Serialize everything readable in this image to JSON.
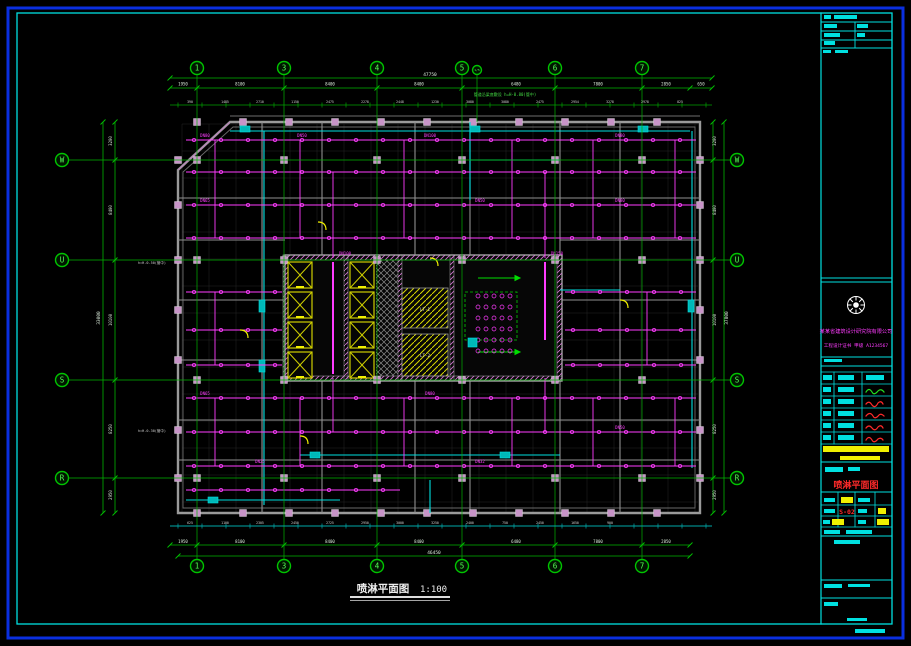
{
  "canvas": {
    "w": 911,
    "h": 646
  },
  "colors": {
    "blue": "#0a2fe0",
    "cyan": "#00e0e0",
    "green": "#00c400",
    "dimline": "#00b400",
    "dimtext": "#dcecdc",
    "magenta": "#ff3cff",
    "yellow": "#f0f000",
    "red": "#ff2a2a",
    "wall": "#9a9a9a",
    "column": "#c894c8",
    "teal": "#00a8a8"
  },
  "titles": {
    "bottom_title": "喷淋平面图",
    "scale": "1:100",
    "red_title": "喷淋平面图",
    "sheet_no": "S-02"
  },
  "company": {
    "line1": "某某省建筑设计研究院有限公司",
    "line2": "工程设计证书 甲级 A1234567"
  },
  "notes": {
    "top": "管道沿梁底敷设 h=H-0.80(管中)",
    "left1": "h=H-0.50(管中)",
    "left2": "h=H-0.30(管中)"
  },
  "rooms": {
    "stair1": "LT-1",
    "stair2": "LT-2"
  },
  "grid": {
    "cols": [
      {
        "label": "1",
        "x": 197
      },
      {
        "label": "3",
        "x": 284
      },
      {
        "label": "4",
        "x": 377
      },
      {
        "label": "5",
        "x": 462
      },
      {
        "label": "1/5",
        "x": 477,
        "small": true
      },
      {
        "label": "6",
        "x": 555
      },
      {
        "label": "7",
        "x": 642
      }
    ],
    "rows": [
      {
        "label": "W",
        "y": 160
      },
      {
        "label": "U",
        "y": 260
      },
      {
        "label": "S",
        "y": 380
      },
      {
        "label": "R",
        "y": 478
      }
    ],
    "top_bubble_y": 68,
    "bottom_bubble_y": 566,
    "left_bubble_x": 62,
    "right_bubble_x": 737
  },
  "dims": {
    "top_total": {
      "t": "47750",
      "x": 430,
      "y": 76
    },
    "bottom_total": {
      "t": "46450",
      "x": 434,
      "y": 554
    },
    "left_total": {
      "t": "33000",
      "x": 100,
      "y": 318
    },
    "right_total": {
      "t": "37800",
      "x": 728,
      "y": 318
    },
    "top_bounds": [
      170,
      197,
      284,
      377,
      462,
      555,
      642,
      690,
      712
    ],
    "bottom_bounds": [
      170,
      197,
      284,
      377,
      462,
      555,
      642,
      690
    ],
    "side_bounds": [
      122,
      160,
      260,
      380,
      478,
      513
    ],
    "top_segments": [
      {
        "t": "1950",
        "x": 183
      },
      {
        "t": "8100",
        "x": 240
      },
      {
        "t": "8400",
        "x": 330
      },
      {
        "t": "8400",
        "x": 419
      },
      {
        "t": "6480",
        "x": 516
      },
      {
        "t": "7800",
        "x": 598
      },
      {
        "t": "2850",
        "x": 666
      },
      {
        "t": "650",
        "x": 701
      }
    ],
    "bottom_segments": [
      {
        "t": "1950",
        "x": 183
      },
      {
        "t": "8100",
        "x": 240
      },
      {
        "t": "8400",
        "x": 330
      },
      {
        "t": "8400",
        "x": 419
      },
      {
        "t": "6480",
        "x": 516
      },
      {
        "t": "7800",
        "x": 598
      },
      {
        "t": "2850",
        "x": 666
      }
    ],
    "left_segments": [
      {
        "t": "3200",
        "y": 141
      },
      {
        "t": "8400",
        "y": 210
      },
      {
        "t": "10100",
        "y": 320
      },
      {
        "t": "8250",
        "y": 429
      },
      {
        "t": "2950",
        "y": 495
      }
    ],
    "right_segments": [
      {
        "t": "3200",
        "y": 141
      },
      {
        "t": "8400",
        "y": 210
      },
      {
        "t": "10100",
        "y": 320
      },
      {
        "t": "8250",
        "y": 429
      },
      {
        "t": "2950",
        "y": 495
      }
    ],
    "top_ticks": [
      "390",
      "1485",
      "2710",
      "1150",
      "2475",
      "2278",
      "2448",
      "1230",
      "3080",
      "3080",
      "2475",
      "2954",
      "3278",
      "2978",
      "825"
    ],
    "bottom_ticks": [
      "625",
      "1100",
      "2305",
      "2450",
      "2725",
      "2950",
      "3000",
      "3250",
      "2400",
      "750",
      "2450",
      "1650",
      "900"
    ]
  },
  "ceil_grid": {
    "x1": 182,
    "x2": 698,
    "y1": 124,
    "y2": 512,
    "step": 27
  },
  "pipes": {
    "head_gap": 27,
    "rows": [
      [
        140,
        186,
        696
      ],
      [
        172,
        186,
        696
      ],
      [
        205,
        186,
        696
      ],
      [
        238,
        186,
        696
      ],
      [
        292,
        186,
        282
      ],
      [
        292,
        565,
        696
      ],
      [
        330,
        186,
        282
      ],
      [
        330,
        565,
        696
      ],
      [
        365,
        186,
        282
      ],
      [
        365,
        565,
        696
      ],
      [
        398,
        186,
        696
      ],
      [
        432,
        186,
        696
      ],
      [
        466,
        186,
        696
      ],
      [
        490,
        186,
        400
      ]
    ],
    "vlines": [
      [
        215,
        140,
        238
      ],
      [
        300,
        140,
        238
      ],
      [
        404,
        140,
        238
      ],
      [
        512,
        140,
        238
      ],
      [
        593,
        140,
        238
      ],
      [
        675,
        140,
        238
      ],
      [
        215,
        292,
        365
      ],
      [
        647,
        292,
        365
      ],
      [
        215,
        398,
        466
      ],
      [
        300,
        398,
        466
      ],
      [
        404,
        398,
        466
      ],
      [
        512,
        398,
        466
      ],
      [
        593,
        398,
        466
      ],
      [
        675,
        398,
        466
      ],
      [
        333,
        172,
        258
      ],
      [
        545,
        172,
        258
      ],
      [
        333,
        378,
        432
      ],
      [
        545,
        378,
        432
      ]
    ],
    "risers": [
      [
        333,
        262,
        374
      ],
      [
        545,
        262,
        340
      ]
    ],
    "dn_labels": [
      {
        "t": "DN80",
        "x": 205,
        "y": 137
      },
      {
        "t": "DN50",
        "x": 302,
        "y": 137
      },
      {
        "t": "DN100",
        "x": 430,
        "y": 137
      },
      {
        "t": "DN80",
        "x": 620,
        "y": 137
      },
      {
        "t": "DN65",
        "x": 205,
        "y": 202
      },
      {
        "t": "DN50",
        "x": 480,
        "y": 202
      },
      {
        "t": "DN80",
        "x": 620,
        "y": 202
      },
      {
        "t": "DN100",
        "x": 345,
        "y": 255
      },
      {
        "t": "DN150",
        "x": 557,
        "y": 255
      },
      {
        "t": "DN65",
        "x": 205,
        "y": 395
      },
      {
        "t": "DN80",
        "x": 430,
        "y": 395
      },
      {
        "t": "DN50",
        "x": 620,
        "y": 429
      },
      {
        "t": "DN25",
        "x": 260,
        "y": 463
      },
      {
        "t": "DN32",
        "x": 480,
        "y": 463
      }
    ]
  },
  "cyan_pipes": [
    [
      230,
      131,
      690,
      131
    ],
    [
      264,
      131,
      264,
      505
    ],
    [
      692,
      131,
      692,
      468
    ],
    [
      300,
      455,
      560,
      455
    ],
    [
      186,
      500,
      340,
      500
    ],
    [
      470,
      122,
      470,
      200
    ],
    [
      470,
      160,
      560,
      160
    ],
    [
      430,
      480,
      430,
      513
    ],
    [
      560,
      290,
      620,
      290
    ]
  ],
  "cyan_boxes": [
    [
      240,
      126,
      10,
      6
    ],
    [
      470,
      126,
      10,
      6
    ],
    [
      638,
      126,
      10,
      6
    ],
    [
      259,
      300,
      6,
      12
    ],
    [
      259,
      360,
      6,
      12
    ],
    [
      688,
      300,
      6,
      12
    ],
    [
      310,
      452,
      10,
      6
    ],
    [
      500,
      452,
      10,
      6
    ],
    [
      208,
      497,
      10,
      6
    ],
    [
      468,
      338,
      9,
      9
    ]
  ],
  "columns": {
    "xs_top": [
      197,
      243,
      289,
      335,
      381,
      427,
      473,
      519,
      565,
      611,
      657
    ],
    "ys_wall": [
      122,
      513
    ],
    "xs_side": [
      178,
      700
    ],
    "ys_side": [
      160,
      205,
      260,
      310,
      360,
      430,
      478
    ],
    "xs_main": [
      197,
      284,
      377,
      462,
      555,
      642
    ],
    "ys_main": [
      160,
      260,
      380,
      478
    ]
  },
  "elevators": [
    [
      288,
      262
    ],
    [
      288,
      292
    ],
    [
      288,
      322
    ],
    [
      288,
      352
    ],
    [
      350,
      262
    ],
    [
      350,
      292
    ],
    [
      350,
      322
    ],
    [
      350,
      352
    ]
  ],
  "cluster": {
    "x": 478,
    "y": 296,
    "cols": 5,
    "rows": 6,
    "dx": 8,
    "dy": 11
  },
  "strips": {
    "top_y": 105,
    "bottom_y": 526,
    "x1": 170,
    "x2": 712,
    "tick_step": 24,
    "label_step": 35,
    "label_x0": 190
  }
}
